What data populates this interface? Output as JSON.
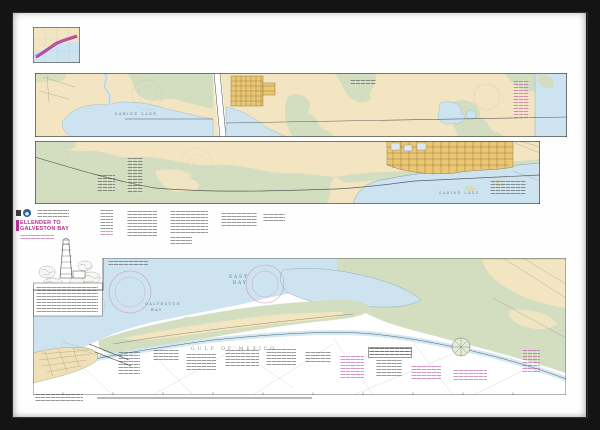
{
  "artwork": {
    "description": "framed NOAA strip nautical chart print",
    "frame_color": "#141414",
    "mat_color": "#fefefe"
  },
  "chart": {
    "title_block": {
      "title_line1": "ELLENDER TO",
      "title_line2": "GALVESTON BAY",
      "accent_color": "#b2308f"
    },
    "labels": {
      "strip1_water": "SABINE LAKE",
      "strip2_water": "SABINE LAKE",
      "bay_upper_line1": "EAST",
      "bay_upper_line2": "BAY",
      "bay_lower_line1": "GALVESTON",
      "bay_lower_line2": "BAY",
      "gulf": "GULF OF MEXICO"
    },
    "colors": {
      "land_tan": "#f3e5c2",
      "marsh_green": "#d2debf",
      "water_blue": "#cde4f0",
      "city_yellow": "#ecc773",
      "noaa_magenta": "#b2308f",
      "note_pink": "#bb51a8"
    }
  }
}
